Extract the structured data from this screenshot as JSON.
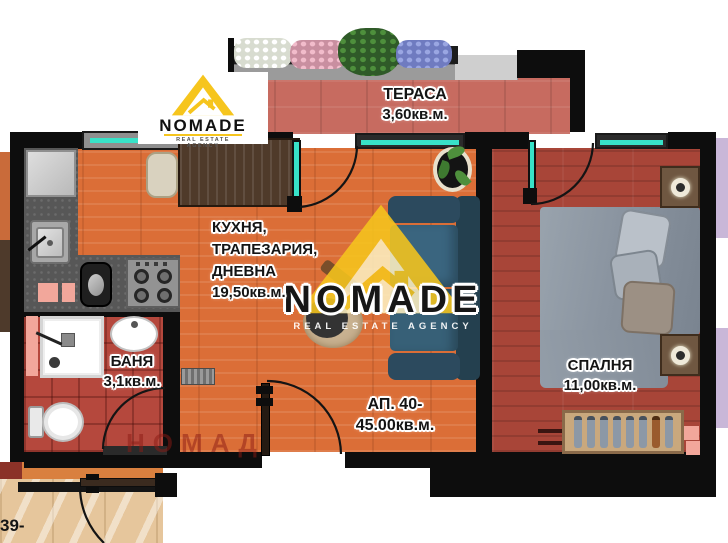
{
  "branding": {
    "logo_name": "NOMADE",
    "logo_tagline": "REAL ESTATE AGENCY",
    "watermark_name": "NOMADE",
    "watermark_tagline": "REAL ESTATE AGENCY",
    "watermark_cyrillic": "НОМАД"
  },
  "unit": {
    "label_line1": "АП. 40-",
    "label_line2": "45.00кв.м.",
    "neighbor_label": "39-"
  },
  "rooms": {
    "terrace": {
      "name": "ТЕРАСА",
      "area": "3,60кв.м."
    },
    "kitchen_living": {
      "line1": "КУХНЯ,",
      "line2": "ТРАПЕЗАРИЯ,",
      "line3": "ДНЕВНА",
      "area": "19,50кв.м."
    },
    "bathroom": {
      "name": "БАНЯ",
      "area": "3,1кв.м."
    },
    "bedroom": {
      "name": "СПАЛНЯ",
      "area": "11,00кв.м."
    }
  },
  "colors": {
    "brand_yellow": "#F6C51D",
    "wall": "#0D0D0D",
    "glass": "#38E2C8",
    "floor_living": "#DB6E37",
    "floor_bedroom": "#A84538",
    "floor_terrace": "#C76B60",
    "floor_bath": "#B5483D",
    "floor_corridor": "#E6C69C",
    "sofa": "#2C4A5E",
    "accent_pink": "#F2A79B"
  }
}
